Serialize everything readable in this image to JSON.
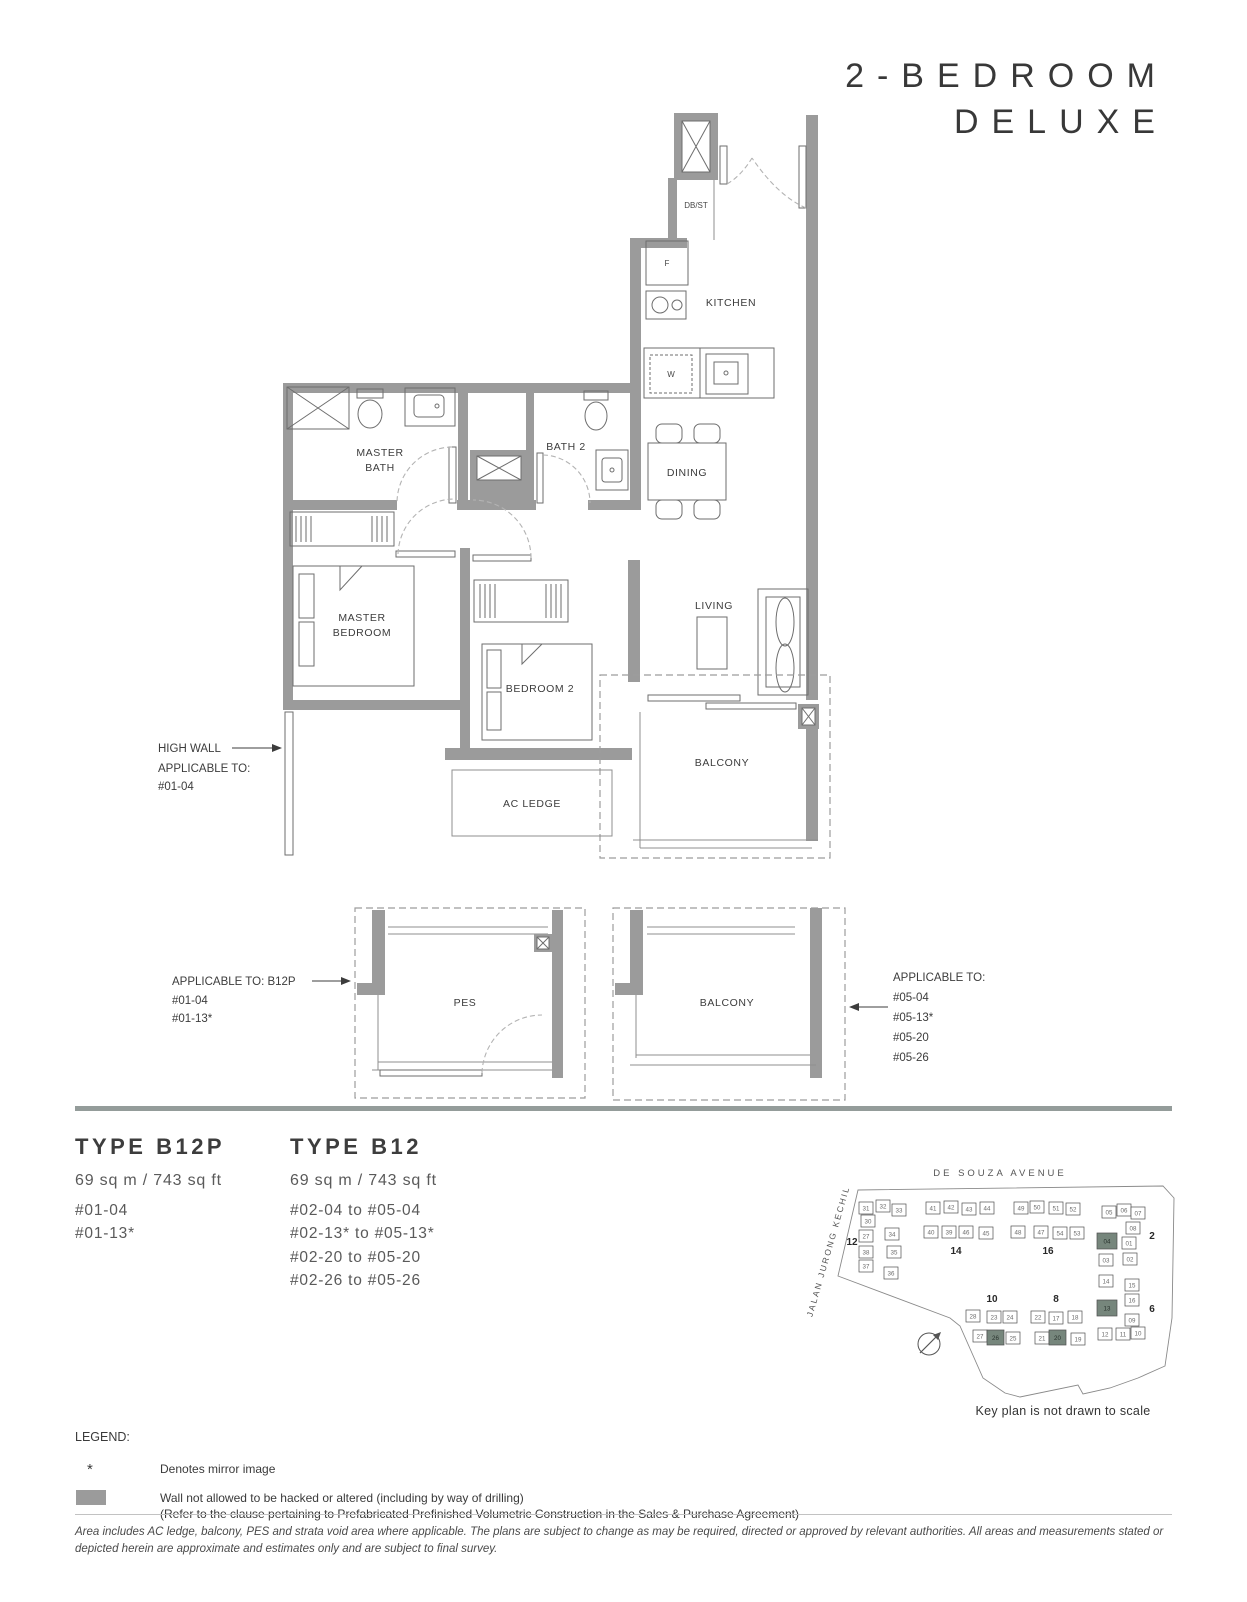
{
  "title": {
    "line1": "2-BEDROOM",
    "line2": "DELUXE"
  },
  "plan": {
    "rooms": {
      "kitchen": "KITCHEN",
      "dining": "DINING",
      "living": "LIVING",
      "master_bath_1": "MASTER",
      "master_bath_2": "BATH",
      "bath2": "BATH 2",
      "master_bedroom_1": "MASTER",
      "master_bedroom_2": "BEDROOM",
      "bedroom2": "BEDROOM 2",
      "balcony": "BALCONY",
      "ac_ledge": "AC LEDGE",
      "db_st": "DB/ST",
      "fridge": "F",
      "washer": "W",
      "pes": "PES",
      "balcony_option": "BALCONY"
    },
    "annotations": {
      "high_wall": {
        "title": "HIGH WALL",
        "line1": "APPLICABLE TO:",
        "line2": "#01-04"
      },
      "pes": {
        "title": "APPLICABLE TO: B12P",
        "line1": "#01-04",
        "line2": "#01-13*"
      },
      "balcony": {
        "title": "APPLICABLE TO:",
        "line1": "#05-04",
        "line2": "#05-13*",
        "line3": "#05-20",
        "line4": "#05-26"
      }
    }
  },
  "types": [
    {
      "name": "TYPE B12P",
      "area": "69 sq m / 743 sq ft",
      "units": [
        "#01-04",
        "#01-13*"
      ]
    },
    {
      "name": "TYPE B12",
      "area": "69 sq m / 743 sq ft",
      "units": [
        "#02-04 to #05-04",
        "#02-13* to #05-13*",
        "#02-20 to #05-20",
        "#02-26 to #05-26"
      ]
    }
  ],
  "keyplan": {
    "road_top": "DE SOUZA AVENUE",
    "road_left": "JALAN JURONG KECHIL",
    "note": "Key plan is not drawn to scale",
    "highlight_color": "#76867c",
    "blocks": [
      {
        "label": "12",
        "lx": 57,
        "ly": 107,
        "units": [
          {
            "n": "31",
            "x": 64,
            "y": 64
          },
          {
            "n": "32",
            "x": 81,
            "y": 62
          },
          {
            "n": "33",
            "x": 97,
            "y": 66
          },
          {
            "n": "30",
            "x": 66,
            "y": 77
          },
          {
            "n": "27",
            "x": 64,
            "y": 92
          },
          {
            "n": "34",
            "x": 90,
            "y": 90
          },
          {
            "n": "38",
            "x": 64,
            "y": 108
          },
          {
            "n": "35",
            "x": 92,
            "y": 108
          },
          {
            "n": "37",
            "x": 64,
            "y": 122
          },
          {
            "n": "36",
            "x": 89,
            "y": 129
          }
        ]
      },
      {
        "label": "14",
        "lx": 161,
        "ly": 116,
        "units": [
          {
            "n": "41",
            "x": 131,
            "y": 64
          },
          {
            "n": "42",
            "x": 149,
            "y": 63
          },
          {
            "n": "43",
            "x": 167,
            "y": 65
          },
          {
            "n": "44",
            "x": 185,
            "y": 64
          },
          {
            "n": "40",
            "x": 129,
            "y": 88
          },
          {
            "n": "39",
            "x": 147,
            "y": 88
          },
          {
            "n": "46",
            "x": 164,
            "y": 88
          },
          {
            "n": "45",
            "x": 184,
            "y": 89
          }
        ]
      },
      {
        "label": "16",
        "lx": 253,
        "ly": 116,
        "units": [
          {
            "n": "49",
            "x": 219,
            "y": 64
          },
          {
            "n": "50",
            "x": 235,
            "y": 63
          },
          {
            "n": "51",
            "x": 254,
            "y": 64
          },
          {
            "n": "52",
            "x": 271,
            "y": 65
          },
          {
            "n": "48",
            "x": 216,
            "y": 88
          },
          {
            "n": "47",
            "x": 239,
            "y": 88
          },
          {
            "n": "54",
            "x": 258,
            "y": 89
          },
          {
            "n": "53",
            "x": 275,
            "y": 89
          }
        ]
      },
      {
        "label": "10",
        "lx": 197,
        "ly": 164,
        "units": [
          {
            "n": "28",
            "x": 171,
            "y": 172
          },
          {
            "n": "23",
            "x": 192,
            "y": 173
          },
          {
            "n": "24",
            "x": 208,
            "y": 173
          },
          {
            "n": "27",
            "x": 178,
            "y": 192
          },
          {
            "n": "26",
            "x": 192,
            "y": 192,
            "hl": true,
            "w": 17,
            "h": 15
          },
          {
            "n": "25",
            "x": 211,
            "y": 194
          }
        ]
      },
      {
        "label": "8",
        "lx": 261,
        "ly": 164,
        "units": [
          {
            "n": "22",
            "x": 236,
            "y": 173
          },
          {
            "n": "17",
            "x": 254,
            "y": 174
          },
          {
            "n": "18",
            "x": 273,
            "y": 173
          },
          {
            "n": "21",
            "x": 240,
            "y": 194
          },
          {
            "n": "20",
            "x": 254,
            "y": 192,
            "hl": true,
            "w": 17,
            "h": 15
          },
          {
            "n": "19",
            "x": 276,
            "y": 195
          }
        ]
      },
      {
        "label": "2",
        "lx": 357,
        "ly": 101,
        "units": [
          {
            "n": "05",
            "x": 307,
            "y": 68
          },
          {
            "n": "06",
            "x": 322,
            "y": 66
          },
          {
            "n": "07",
            "x": 336,
            "y": 69
          },
          {
            "n": "08",
            "x": 331,
            "y": 84
          },
          {
            "n": "04",
            "x": 302,
            "y": 95,
            "hl": true,
            "w": 20,
            "h": 16
          },
          {
            "n": "01",
            "x": 327,
            "y": 99
          },
          {
            "n": "03",
            "x": 304,
            "y": 116
          },
          {
            "n": "02",
            "x": 328,
            "y": 115
          }
        ]
      },
      {
        "label": "6",
        "lx": 357,
        "ly": 174,
        "units": [
          {
            "n": "14",
            "x": 304,
            "y": 137
          },
          {
            "n": "15",
            "x": 330,
            "y": 141
          },
          {
            "n": "16",
            "x": 330,
            "y": 156
          },
          {
            "n": "13",
            "x": 302,
            "y": 162,
            "hl": true,
            "w": 20,
            "h": 16
          },
          {
            "n": "09",
            "x": 330,
            "y": 176
          },
          {
            "n": "12",
            "x": 303,
            "y": 190
          },
          {
            "n": "11",
            "x": 321,
            "y": 190
          },
          {
            "n": "10",
            "x": 336,
            "y": 189
          }
        ]
      }
    ]
  },
  "legend": {
    "title": "LEGEND:",
    "mirror_symbol": "*",
    "mirror_text": "Denotes mirror image",
    "wall_text_1": "Wall not allowed to be hacked or altered (including by way of drilling)",
    "wall_text_2": "(Refer to the clause pertaining to Prefabricated Prefinished Volumetric Construction in the Sales & Purchase Agreement)"
  },
  "disclaimer": "Area includes AC ledge, balcony, PES and strata void area where applicable. The plans are subject to change as may be required, directed or approved by relevant authorities. All areas and measurements stated or depicted herein are approximate and estimates only and are subject to final survey."
}
